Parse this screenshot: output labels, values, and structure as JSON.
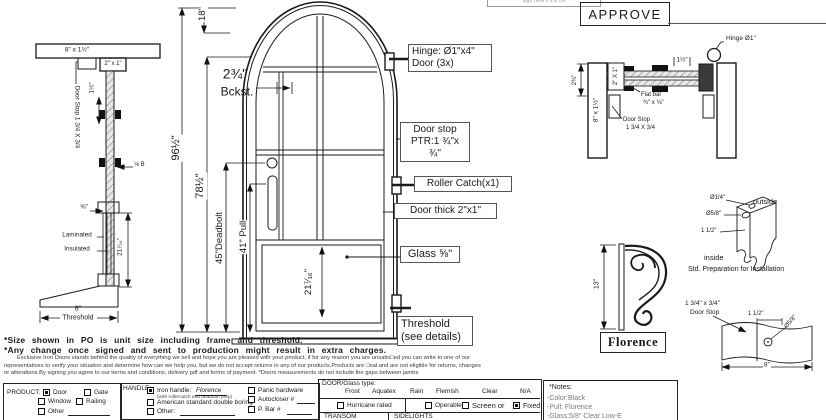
{
  "colors": {
    "ink": "#1a1a1a",
    "muted": "#7a7a7a",
    "background": "#ffffff"
  },
  "header": {
    "sign_box": "Sign Here if it is OK",
    "approve": "APPROVE"
  },
  "jamb_section": {
    "frame": "8\" x 1½\"",
    "profile": "2\" x 1\"",
    "door_stop": "Door Stop 1 3/4 X 3/4",
    "clip_spacing": "1½\"",
    "flat_bar": "⅛ B",
    "glass_thickness": "⅝\"",
    "laminated": "Laminated",
    "insulated": "Insulated",
    "glass_height": "21⁷⁄₁₆\"",
    "threshold_width": "8\"",
    "threshold": "Threshold"
  },
  "elevation": {
    "arch_rise": "18\"",
    "backset": "2¾\"",
    "backset_label": "Bckst.",
    "total_height": "96½\"",
    "frame_height": "78½\"",
    "deadbolt_height": "45\"Deadbolt",
    "pull_height": "41\" Pull",
    "panel_height": "21⁷⁄₁₆\"",
    "callouts": {
      "hinge": [
        "Hinge: Ø1\"x4\"",
        "Door (3x)"
      ],
      "door_stop": [
        "Door stop",
        "PTR:1 ¾\"x ¾\""
      ],
      "roller_catch": "Roller Catch(x1)",
      "door_thick": "Door thick 2\"x1\"",
      "glass": "Glass ⅝\"",
      "threshold": [
        "Threshold",
        "(see details)"
      ]
    }
  },
  "plan_section": {
    "jamb": "8\" x 1½\"",
    "door_profile": "2\" X 1\"",
    "hinge": "Hinge Ø1\"",
    "gap": "1½\"",
    "jamb_depth": "2¾\"",
    "flat_bar": [
      "Flat bar",
      "¾\" x ⅛\""
    ],
    "door_stop": [
      "Door Stop",
      "1 3/4 X 3/4"
    ]
  },
  "prep_detail": {
    "hole_small": "Ø1/4\"",
    "hole_large": "Ø5/8\"",
    "spacing": "1 1/2\"",
    "outside": "outside",
    "inside": "inside",
    "caption": "Std. Preparation for Installation"
  },
  "pull_detail": {
    "height": "13\"",
    "name": "Florence"
  },
  "stop_detail": {
    "label": [
      "1 3/4\" x 3/4\"",
      "Door Stop"
    ],
    "offset": "1 1/2\"",
    "hole": "Ø5/8\"",
    "width": "8\""
  },
  "footnotes": {
    "line1": "*Size shown in PO is unit size including frame and threshold.",
    "line2": "*Any change once signed and sent to production might result in extra charges.",
    "fine1": "Exclusive Iron Doors stands behind the quality of everything we sell and hope you are pleased with your product, if for any reason you are unsatis□ed you can write to one of our",
    "fine2": "representatives to verify your situation and determine how can we help you, but we do not accept returns in any of our products.Products are □nal and are not eligible for returns, changes",
    "fine3": "or alterations.By signing you agree to our terms and conditions, delivery pdf and forms of payment. *Doors measurements do not include the gaps between jambs"
  },
  "form": {
    "product": {
      "label": "PRODUCT:",
      "options": [
        {
          "label": "Door",
          "checked": true
        },
        {
          "label": "Gate",
          "checked": false
        },
        {
          "label": "Window",
          "checked": false
        },
        {
          "label": "Railing",
          "checked": false
        },
        {
          "label": "Other",
          "checked": false
        }
      ]
    },
    "handle": {
      "label": "HANDLE:",
      "iron": {
        "checked": true,
        "label": "Iron handle:",
        "value": "Florence",
        "sub": "(with rollercatch and deadbolt prep)"
      },
      "american": {
        "checked": false,
        "label": "American standard double boring"
      },
      "other": {
        "checked": false,
        "label": "Other:"
      },
      "panic": {
        "checked": false,
        "label": "Panic hardware"
      },
      "autocloser": {
        "checked": false,
        "label": "Autocloser #"
      },
      "pbar": {
        "checked": false,
        "label": "P. Bar #"
      }
    },
    "glass": {
      "label": "DOOR/Glass type:",
      "types": [
        "Frost",
        "Aquatex",
        "Rain",
        "Flemish",
        "Clear",
        "N/A"
      ],
      "hurricane": {
        "checked": false,
        "label": "Hurricane rated"
      },
      "operable": {
        "checked": false,
        "label": "Operable"
      },
      "screen": {
        "checked": false,
        "label": "Screen or"
      },
      "fixed": {
        "checked": true,
        "label": "Fixed"
      },
      "transom": "TRANSOM",
      "sidelights": "SIDELIGHTS"
    },
    "notes": {
      "title": "*Notes:",
      "items": [
        "-Color:Black",
        "-Pull: Florence",
        "-Glass:5/8\" Clear Low-E"
      ]
    }
  }
}
